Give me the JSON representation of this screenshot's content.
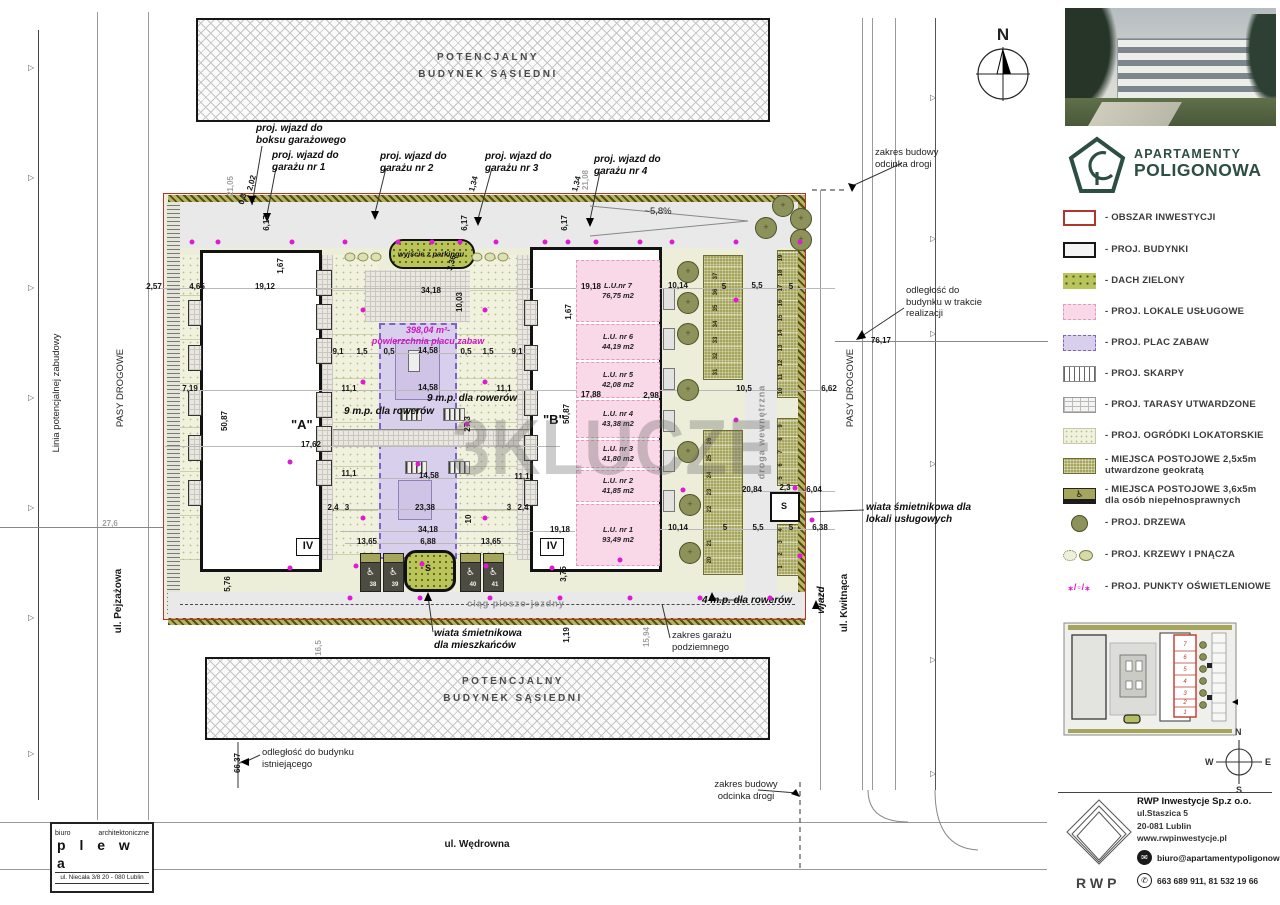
{
  "watermark": "3KLUCZE",
  "north": "N",
  "brand": {
    "line1": "APARTAMENTY",
    "line2": "POLIGONOWA",
    "color": "#2d4f43"
  },
  "buildings": {
    "a": "\"A\"",
    "b": "\"B\"",
    "storeys": "IV",
    "shed": "S"
  },
  "compass": {
    "n": "N",
    "e": "E",
    "s": "S",
    "w": "W"
  },
  "architect": {
    "line1": "biuro",
    "line2": "architektoniczne",
    "name": "p l e w a",
    "address": "ul. Niecała 3/8  20 - 080 Lublin"
  },
  "company": {
    "name": "RWP Inwestycje Sp.z o.o.",
    "street": "ul.Staszica 5",
    "city": "20-081 Lublin",
    "www": "www.rwpinwestycje.pl",
    "email": "biuro@apartamentypoligonowa.pl",
    "phones": "663 689 911,  81 532 19 66",
    "logo": "RWP"
  },
  "legend": [
    {
      "y": 210,
      "type": "obszar",
      "label": "- OBSZAR INWESTYCJI"
    },
    {
      "y": 242,
      "type": "budynki",
      "label": "- PROJ. BUDYNKI"
    },
    {
      "y": 273,
      "type": "dach",
      "label": "- DACH ZIELONY"
    },
    {
      "y": 304,
      "type": "lokale",
      "label": "- PROJ. LOKALE USŁUGOWE"
    },
    {
      "y": 335,
      "type": "plac",
      "label": "- PROJ. PLAC ZABAW"
    },
    {
      "y": 366,
      "type": "skarpy",
      "label": "- PROJ. SKARPY"
    },
    {
      "y": 397,
      "type": "tarasy",
      "label": "- PROJ. TARASY UTWARDZONE"
    },
    {
      "y": 428,
      "type": "ogrodki",
      "label": "- PROJ. OGRÓDKI LOKATORSKIE"
    },
    {
      "y": 455,
      "type": "geokrata",
      "label": "- MIEJSCA POSTOJOWE 2,5x5m",
      "label2": "utwardzone geokratą"
    },
    {
      "y": 485,
      "type": "niepelnosprawni",
      "label": "- MIEJSCA POSTOJOWE 3,6x5m",
      "label2": "dla osób niepełnosprawnych",
      "glyph": "♿"
    },
    {
      "y": 515,
      "type": "drzewa",
      "label": "- PROJ. DRZEWA"
    },
    {
      "y": 547,
      "type": "krzewy",
      "label": "- PROJ. KRZEWY I PNĄCZA"
    },
    {
      "y": 579,
      "type": "punkty",
      "label": "- PROJ. PUNKTY OŚWIETLENIOWE",
      "glyph": "⁎/▫/⁎"
    }
  ],
  "lu_units": [
    {
      "name": "L.U.nr 7",
      "area": "76,75 m2",
      "y": 260,
      "h": 62
    },
    {
      "name": "L.U. nr 6",
      "area": "44,19 m2",
      "y": 324,
      "h": 36
    },
    {
      "name": "L.U. nr 5",
      "area": "42,08 m2",
      "y": 362,
      "h": 36
    },
    {
      "name": "L.U. nr 4",
      "area": "43,38 m2",
      "y": 400,
      "h": 38
    },
    {
      "name": "L.U. nr 3",
      "area": "41,80 m2",
      "y": 440,
      "h": 28
    },
    {
      "name": "L.U. nr 2",
      "area": "41,85 m2",
      "y": 470,
      "h": 32
    },
    {
      "name": "L.U. nr 1",
      "area": "93,49 m2",
      "y": 504,
      "h": 62
    }
  ],
  "annotations": [
    {
      "t": "proj. wjazd do\nboksu garażowego",
      "x": 256,
      "y": 123,
      "c": "bi"
    },
    {
      "t": "proj. wjazd do\ngarażu nr 1",
      "x": 272,
      "y": 150,
      "c": "bi"
    },
    {
      "t": "proj. wjazd do\ngarażu nr 2",
      "x": 380,
      "y": 151,
      "c": "bi"
    },
    {
      "t": "proj. wjazd do\ngarażu nr 3",
      "x": 485,
      "y": 151,
      "c": "bi"
    },
    {
      "t": "proj. wjazd do\ngarażu nr 4",
      "x": 594,
      "y": 154,
      "c": "bi"
    },
    {
      "t": "zakres budowy\nodcinka drogi",
      "x": 875,
      "y": 147,
      "c": "nn"
    },
    {
      "t": "odległość do\nbudynku w trakcie\nrealizacji",
      "x": 906,
      "y": 285,
      "c": "nn"
    },
    {
      "t": "PASY DROGOWE",
      "x": 851,
      "y": 388,
      "r": -90,
      "c": "nn",
      "a": "c"
    },
    {
      "t": "ul. Kwitnąca",
      "x": 845,
      "y": 603,
      "r": -90,
      "c": "st",
      "a": "c"
    },
    {
      "t": "wjazd",
      "x": 822,
      "y": 600,
      "r": -90,
      "c": "bi",
      "a": "c"
    },
    {
      "t": "wiata śmietnikowa dla\nlokali usługowych",
      "x": 866,
      "y": 502,
      "c": "bi"
    },
    {
      "t": "droga wewnętrzna",
      "x": 762,
      "y": 432,
      "r": -90,
      "c": "gl",
      "a": "c"
    },
    {
      "t": "~5,8%",
      "x": 658,
      "y": 212,
      "c": "nn",
      "a": "c"
    },
    {
      "t": "wyjście z parkingu",
      "x": 431,
      "y": 254,
      "c": "sm",
      "a": "c"
    },
    {
      "t": "398,04 m²-\npowierzchnia placu zabaw",
      "x": 428,
      "y": 336,
      "c": "mg",
      "a": "c"
    },
    {
      "t": "9 m.p. dla rowerów",
      "x": 472,
      "y": 399,
      "c": "bi",
      "a": "c"
    },
    {
      "t": "9 m.p. dla rowerów",
      "x": 389,
      "y": 412,
      "c": "bi",
      "a": "c"
    },
    {
      "t": "ciąg pieszo-jezdny",
      "x": 516,
      "y": 604,
      "c": "gl",
      "a": "c"
    },
    {
      "t": "4 m.p. dla rowerów",
      "x": 747,
      "y": 601,
      "c": "bi",
      "a": "c"
    },
    {
      "t": "wiata śmietnikowa\ndla mieszkańców",
      "x": 434,
      "y": 628,
      "c": "bi"
    },
    {
      "t": "zakres garażu\npodziemnego",
      "x": 672,
      "y": 630,
      "c": "nn"
    },
    {
      "t": "zakres budowy\nodcinka drogi",
      "x": 746,
      "y": 779,
      "c": "nn",
      "a": "cx"
    },
    {
      "t": "odległość do budynku\nistniejącego",
      "x": 262,
      "y": 747,
      "c": "nn"
    },
    {
      "t": "ul. Wędrowna",
      "x": 477,
      "y": 845,
      "c": "st",
      "a": "c"
    },
    {
      "t": "Linia potencjalnej zabudowy",
      "x": 57,
      "y": 393,
      "r": -90,
      "c": "nn",
      "a": "c"
    },
    {
      "t": "PASY DROGOWE",
      "x": 121,
      "y": 388,
      "r": -90,
      "c": "nn",
      "a": "c"
    },
    {
      "t": "ul. Pejzażowa",
      "x": 119,
      "y": 601,
      "r": -90,
      "c": "st",
      "a": "c"
    },
    {
      "t": "POTENCJALNY\nBUDYNEK SĄSIEDNI",
      "x": 488,
      "y": 66,
      "c": "ng",
      "a": "c"
    },
    {
      "t": "POTENCJALNY\nBUDYNEK SĄSIEDNI",
      "x": 513,
      "y": 690,
      "c": "ng",
      "a": "c"
    }
  ],
  "dims": [
    {
      "t": "21,05",
      "x": 231,
      "y": 186,
      "r": -90,
      "g": 1
    },
    {
      "t": "2,02",
      "x": 252,
      "y": 183,
      "r": -75
    },
    {
      "t": "0,3",
      "x": 243,
      "y": 199,
      "r": -75
    },
    {
      "t": "6,17",
      "x": 267,
      "y": 223,
      "r": -90
    },
    {
      "t": "1,34",
      "x": 474,
      "y": 184,
      "r": -75
    },
    {
      "t": "6,17",
      "x": 465,
      "y": 223,
      "r": -90
    },
    {
      "t": "1,34",
      "x": 577,
      "y": 184,
      "r": -75
    },
    {
      "t": "21,08",
      "x": 586,
      "y": 180,
      "r": -90,
      "g": 1
    },
    {
      "t": "6,17",
      "x": 565,
      "y": 223,
      "r": -90
    },
    {
      "t": "2,57",
      "x": 154,
      "y": 287
    },
    {
      "t": "4,65",
      "x": 197,
      "y": 287
    },
    {
      "t": "19,12",
      "x": 265,
      "y": 287
    },
    {
      "t": "1,67",
      "x": 281,
      "y": 266,
      "r": -90
    },
    {
      "t": "34,18",
      "x": 431,
      "y": 291
    },
    {
      "t": "3,36",
      "x": 452,
      "y": 263,
      "r": -75
    },
    {
      "t": "10,03",
      "x": 460,
      "y": 302,
      "r": -90
    },
    {
      "t": "19,18",
      "x": 591,
      "y": 287
    },
    {
      "t": "1,67",
      "x": 569,
      "y": 312,
      "r": -90
    },
    {
      "t": "10,14",
      "x": 678,
      "y": 286
    },
    {
      "t": "5",
      "x": 724,
      "y": 287
    },
    {
      "t": "5,5",
      "x": 757,
      "y": 286
    },
    {
      "t": "5",
      "x": 791,
      "y": 287
    },
    {
      "t": "9,1",
      "x": 338,
      "y": 352
    },
    {
      "t": "1,5",
      "x": 362,
      "y": 352
    },
    {
      "t": "0,5",
      "x": 389,
      "y": 352
    },
    {
      "t": "14,58",
      "x": 428,
      "y": 351
    },
    {
      "t": "0,5",
      "x": 466,
      "y": 352
    },
    {
      "t": "1,5",
      "x": 488,
      "y": 352
    },
    {
      "t": "9,1",
      "x": 517,
      "y": 352
    },
    {
      "t": "7,19",
      "x": 190,
      "y": 389
    },
    {
      "t": "11,1",
      "x": 349,
      "y": 389
    },
    {
      "t": "14,58",
      "x": 428,
      "y": 388
    },
    {
      "t": "11,1",
      "x": 504,
      "y": 389
    },
    {
      "t": "17,88",
      "x": 591,
      "y": 395
    },
    {
      "t": "2,98",
      "x": 651,
      "y": 396
    },
    {
      "t": "7,16",
      "x": 687,
      "y": 389
    },
    {
      "t": "10,5",
      "x": 744,
      "y": 389
    },
    {
      "t": "6,62",
      "x": 829,
      "y": 389
    },
    {
      "t": "17,62",
      "x": 311,
      "y": 445
    },
    {
      "t": "50,87",
      "x": 225,
      "y": 421,
      "r": -90
    },
    {
      "t": "50,87",
      "x": 567,
      "y": 414,
      "r": -90
    },
    {
      "t": "27,3",
      "x": 468,
      "y": 424,
      "r": -90
    },
    {
      "t": "11,1",
      "x": 349,
      "y": 474
    },
    {
      "t": "14,58",
      "x": 429,
      "y": 476
    },
    {
      "t": "11,1",
      "x": 522,
      "y": 477
    },
    {
      "t": "2,4",
      "x": 333,
      "y": 508
    },
    {
      "t": "3",
      "x": 347,
      "y": 508
    },
    {
      "t": "23,38",
      "x": 425,
      "y": 508
    },
    {
      "t": "3",
      "x": 509,
      "y": 508
    },
    {
      "t": "2,4",
      "x": 523,
      "y": 508
    },
    {
      "t": "34,18",
      "x": 428,
      "y": 530
    },
    {
      "t": "10",
      "x": 469,
      "y": 519,
      "r": -90
    },
    {
      "t": "19,18",
      "x": 560,
      "y": 530
    },
    {
      "t": "13,65",
      "x": 367,
      "y": 542
    },
    {
      "t": "6,88",
      "x": 428,
      "y": 542
    },
    {
      "t": "13,65",
      "x": 491,
      "y": 542
    },
    {
      "t": "20,84",
      "x": 752,
      "y": 490
    },
    {
      "t": "2,3",
      "x": 785,
      "y": 488
    },
    {
      "t": "6,04",
      "x": 814,
      "y": 490
    },
    {
      "t": "10,14",
      "x": 678,
      "y": 528
    },
    {
      "t": "5",
      "x": 725,
      "y": 528
    },
    {
      "t": "5,5",
      "x": 758,
      "y": 528
    },
    {
      "t": "5",
      "x": 791,
      "y": 528
    },
    {
      "t": "6,38",
      "x": 820,
      "y": 528
    },
    {
      "t": "76,17",
      "x": 881,
      "y": 341
    },
    {
      "t": "27,6",
      "x": 110,
      "y": 524,
      "g": 1
    },
    {
      "t": "66,37",
      "x": 238,
      "y": 763,
      "r": -90
    },
    {
      "t": "5,76",
      "x": 228,
      "y": 584,
      "r": -90
    },
    {
      "t": "3,75",
      "x": 564,
      "y": 574,
      "r": -90
    },
    {
      "t": "1,19",
      "x": 567,
      "y": 635,
      "r": -90
    },
    {
      "t": "15,94",
      "x": 647,
      "y": 637,
      "r": -90,
      "g": 1
    },
    {
      "t": "16,5",
      "x": 319,
      "y": 648,
      "r": -90,
      "g": 1
    }
  ],
  "parking": [
    {
      "n": "37",
      "x": 716,
      "y": 276,
      "r": 1
    },
    {
      "n": "36",
      "x": 716,
      "y": 292,
      "r": 1
    },
    {
      "n": "35",
      "x": 716,
      "y": 308,
      "r": 1
    },
    {
      "n": "34",
      "x": 716,
      "y": 324,
      "r": 1
    },
    {
      "n": "33",
      "x": 716,
      "y": 340,
      "r": 1
    },
    {
      "n": "32",
      "x": 716,
      "y": 356,
      "r": 1
    },
    {
      "n": "31",
      "x": 716,
      "y": 372,
      "r": 1
    },
    {
      "n": "26",
      "x": 710,
      "y": 441,
      "r": 1
    },
    {
      "n": "25",
      "x": 710,
      "y": 458,
      "r": 1
    },
    {
      "n": "24",
      "x": 710,
      "y": 475,
      "r": 1
    },
    {
      "n": "23",
      "x": 710,
      "y": 492,
      "r": 1
    },
    {
      "n": "22",
      "x": 710,
      "y": 509,
      "r": 1
    },
    {
      "n": "21",
      "x": 710,
      "y": 543,
      "r": 1
    },
    {
      "n": "20",
      "x": 710,
      "y": 560,
      "r": 1
    },
    {
      "n": "19",
      "x": 781,
      "y": 258,
      "r": 1
    },
    {
      "n": "18",
      "x": 781,
      "y": 273,
      "r": 1
    },
    {
      "n": "17",
      "x": 781,
      "y": 288,
      "r": 1
    },
    {
      "n": "16",
      "x": 781,
      "y": 303,
      "r": 1
    },
    {
      "n": "15",
      "x": 781,
      "y": 318,
      "r": 1
    },
    {
      "n": "14",
      "x": 781,
      "y": 333,
      "r": 1
    },
    {
      "n": "13",
      "x": 781,
      "y": 348,
      "r": 1
    },
    {
      "n": "12",
      "x": 781,
      "y": 363,
      "r": 1
    },
    {
      "n": "11",
      "x": 781,
      "y": 377,
      "r": 1
    },
    {
      "n": "10",
      "x": 781,
      "y": 391,
      "r": 1
    },
    {
      "n": "9",
      "x": 781,
      "y": 426,
      "r": 1
    },
    {
      "n": "8",
      "x": 781,
      "y": 439,
      "r": 1
    },
    {
      "n": "7",
      "x": 781,
      "y": 452,
      "r": 1
    },
    {
      "n": "6",
      "x": 781,
      "y": 465,
      "r": 1
    },
    {
      "n": "5",
      "x": 781,
      "y": 478,
      "r": 1
    },
    {
      "n": "4",
      "x": 781,
      "y": 530,
      "r": 1
    },
    {
      "n": "3",
      "x": 781,
      "y": 542,
      "r": 1
    },
    {
      "n": "2",
      "x": 781,
      "y": 554,
      "r": 1
    },
    {
      "n": "1",
      "x": 781,
      "y": 567,
      "r": 1
    },
    {
      "n": "38",
      "x": 373,
      "y": 585,
      "w": 1
    },
    {
      "n": "39",
      "x": 395,
      "y": 585,
      "w": 1
    },
    {
      "n": "40",
      "x": 473,
      "y": 585,
      "w": 1
    },
    {
      "n": "41",
      "x": 495,
      "y": 585,
      "w": 1
    }
  ],
  "trees": [
    {
      "x": 688,
      "y": 272
    },
    {
      "x": 688,
      "y": 303
    },
    {
      "x": 688,
      "y": 334
    },
    {
      "x": 688,
      "y": 390
    },
    {
      "x": 688,
      "y": 452
    },
    {
      "x": 690,
      "y": 505
    },
    {
      "x": 690,
      "y": 553
    },
    {
      "x": 783,
      "y": 206
    },
    {
      "x": 801,
      "y": 219
    },
    {
      "x": 801,
      "y": 240
    },
    {
      "x": 766,
      "y": 228
    }
  ],
  "shrubs": [
    {
      "x": 350,
      "y": 257
    },
    {
      "x": 363,
      "y": 257
    },
    {
      "x": 376,
      "y": 257
    },
    {
      "x": 477,
      "y": 257
    },
    {
      "x": 490,
      "y": 257
    },
    {
      "x": 503,
      "y": 257
    }
  ],
  "lights": [
    {
      "x": 192,
      "y": 242
    },
    {
      "x": 218,
      "y": 242
    },
    {
      "x": 292,
      "y": 242
    },
    {
      "x": 345,
      "y": 242
    },
    {
      "x": 398,
      "y": 242
    },
    {
      "x": 432,
      "y": 242
    },
    {
      "x": 460,
      "y": 242
    },
    {
      "x": 496,
      "y": 242
    },
    {
      "x": 545,
      "y": 242
    },
    {
      "x": 568,
      "y": 242
    },
    {
      "x": 596,
      "y": 242
    },
    {
      "x": 640,
      "y": 242
    },
    {
      "x": 672,
      "y": 242
    },
    {
      "x": 736,
      "y": 242
    },
    {
      "x": 800,
      "y": 242
    },
    {
      "x": 363,
      "y": 310
    },
    {
      "x": 485,
      "y": 310
    },
    {
      "x": 363,
      "y": 382
    },
    {
      "x": 485,
      "y": 382
    },
    {
      "x": 467,
      "y": 424
    },
    {
      "x": 290,
      "y": 462
    },
    {
      "x": 418,
      "y": 464
    },
    {
      "x": 363,
      "y": 518
    },
    {
      "x": 485,
      "y": 518
    },
    {
      "x": 290,
      "y": 568
    },
    {
      "x": 356,
      "y": 566
    },
    {
      "x": 422,
      "y": 564
    },
    {
      "x": 486,
      "y": 566
    },
    {
      "x": 552,
      "y": 568
    },
    {
      "x": 620,
      "y": 560
    },
    {
      "x": 350,
      "y": 598
    },
    {
      "x": 420,
      "y": 598
    },
    {
      "x": 490,
      "y": 598
    },
    {
      "x": 560,
      "y": 598
    },
    {
      "x": 630,
      "y": 598
    },
    {
      "x": 700,
      "y": 598
    },
    {
      "x": 770,
      "y": 598
    },
    {
      "x": 683,
      "y": 490
    },
    {
      "x": 795,
      "y": 488
    },
    {
      "x": 736,
      "y": 300
    },
    {
      "x": 736,
      "y": 420
    },
    {
      "x": 800,
      "y": 556
    },
    {
      "x": 812,
      "y": 520
    }
  ]
}
